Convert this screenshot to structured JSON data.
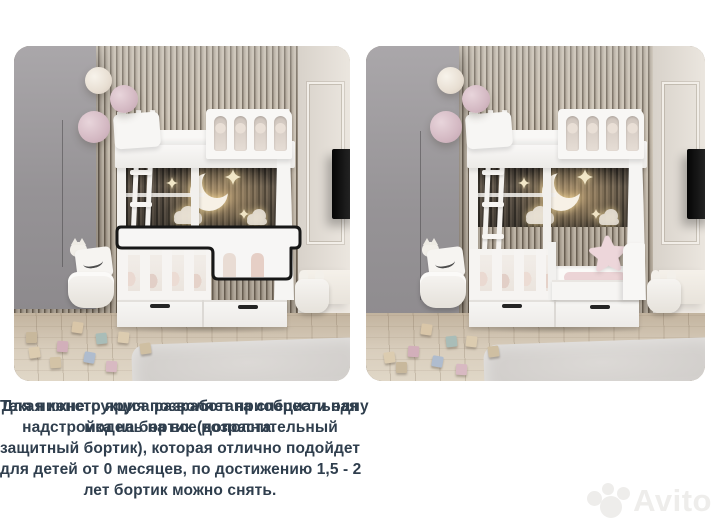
{
  "captions": {
    "left_lines": [
      "Для нижнего яруса разработана специальная",
      "надстройка на бортик (дополнительный",
      "защитный бортик), которая отлично подойдет",
      "для детей от 0 месяцев, по достижению 1,5 - 2",
      "лет бортик можно снять."
    ],
    "right_lines": [
      "Такая конструкция позволяет приобрести одну",
      "модель на все возраста."
    ]
  },
  "watermark": {
    "text": "Avito"
  },
  "colors": {
    "caption_text": "#2f3e4d",
    "highlight_outline": "#171717",
    "watermark": "#eeedeb",
    "bed_white": "#f6f5f4"
  }
}
